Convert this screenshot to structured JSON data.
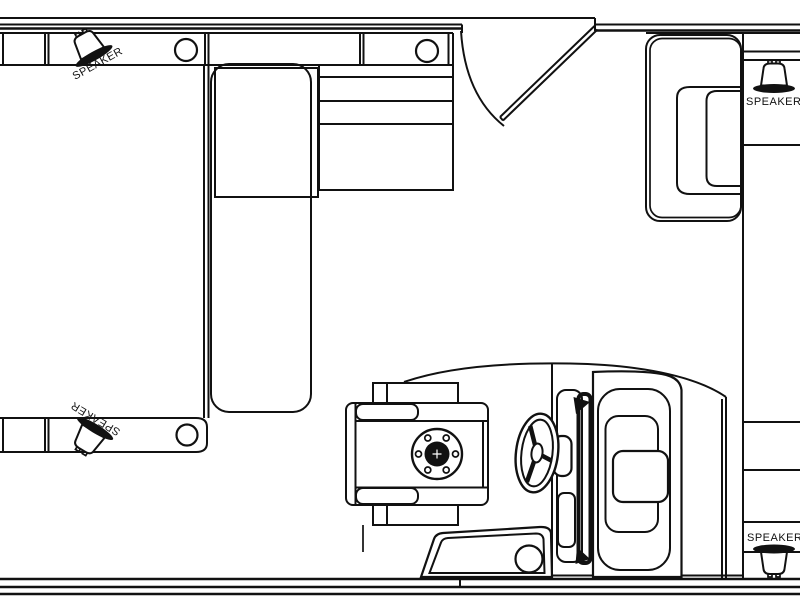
{
  "diagram": {
    "type": "pontoon-boat-deck-floor-plan",
    "orientation": "top-down",
    "features": [
      "port-bow-bench",
      "chaise-lounge",
      "storage-console",
      "boarding-gate",
      "port-stern-bench",
      "captains-chair",
      "seat-pedestal",
      "steering-wheel",
      "helm-console",
      "kick-panel",
      "starboard-seat",
      "starboard-gunwale",
      "cup-holders",
      "speakers"
    ]
  },
  "colors": {
    "line": "#111111",
    "background": "#ffffff",
    "speaker_flange_fill": "#111111"
  },
  "speakers": [
    {
      "id": "top-left",
      "label": "SPEAKER",
      "rotation_deg": -29
    },
    {
      "id": "top-right",
      "label": "SPEAKER",
      "rotation_deg": 0
    },
    {
      "id": "bottom-left",
      "label": "SPEAKER",
      "rotation_deg": 211
    },
    {
      "id": "bottom-right",
      "label": "SPEAKER",
      "rotation_deg": 180
    }
  ]
}
